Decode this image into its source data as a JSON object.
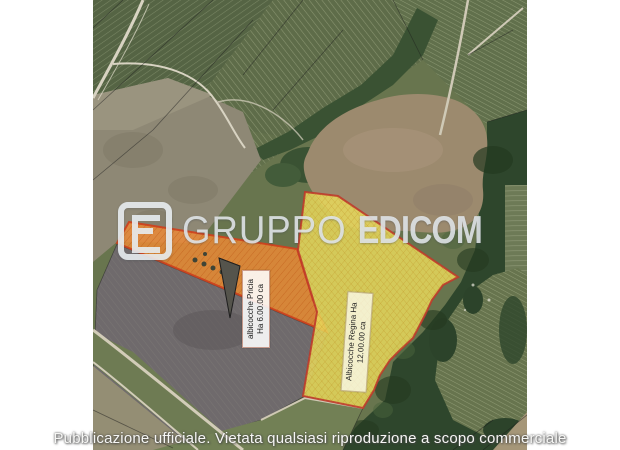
{
  "watermark": {
    "brand_prefix": "GRUPPO",
    "brand_suffix": "EDICOM",
    "logo_color": "#e7ecef"
  },
  "disclaimer": "Pubblicazione ufficiale. Vietata qualsiasi riproduzione a scopo commerciale",
  "parcels": [
    {
      "name": "parcel-albicocche-pricia",
      "label_line1": "albicocche Pricia",
      "label_line2": "Ha 6.00.00 ca",
      "fill": "#ee8a34",
      "border": "#cf3f1d"
    },
    {
      "name": "parcel-albicocche-regina",
      "label_line1": "Albicocche Regina Ha",
      "label_line2": "12.00.00 ca",
      "fill": "#e8d85c",
      "border": "#bf392b"
    }
  ]
}
